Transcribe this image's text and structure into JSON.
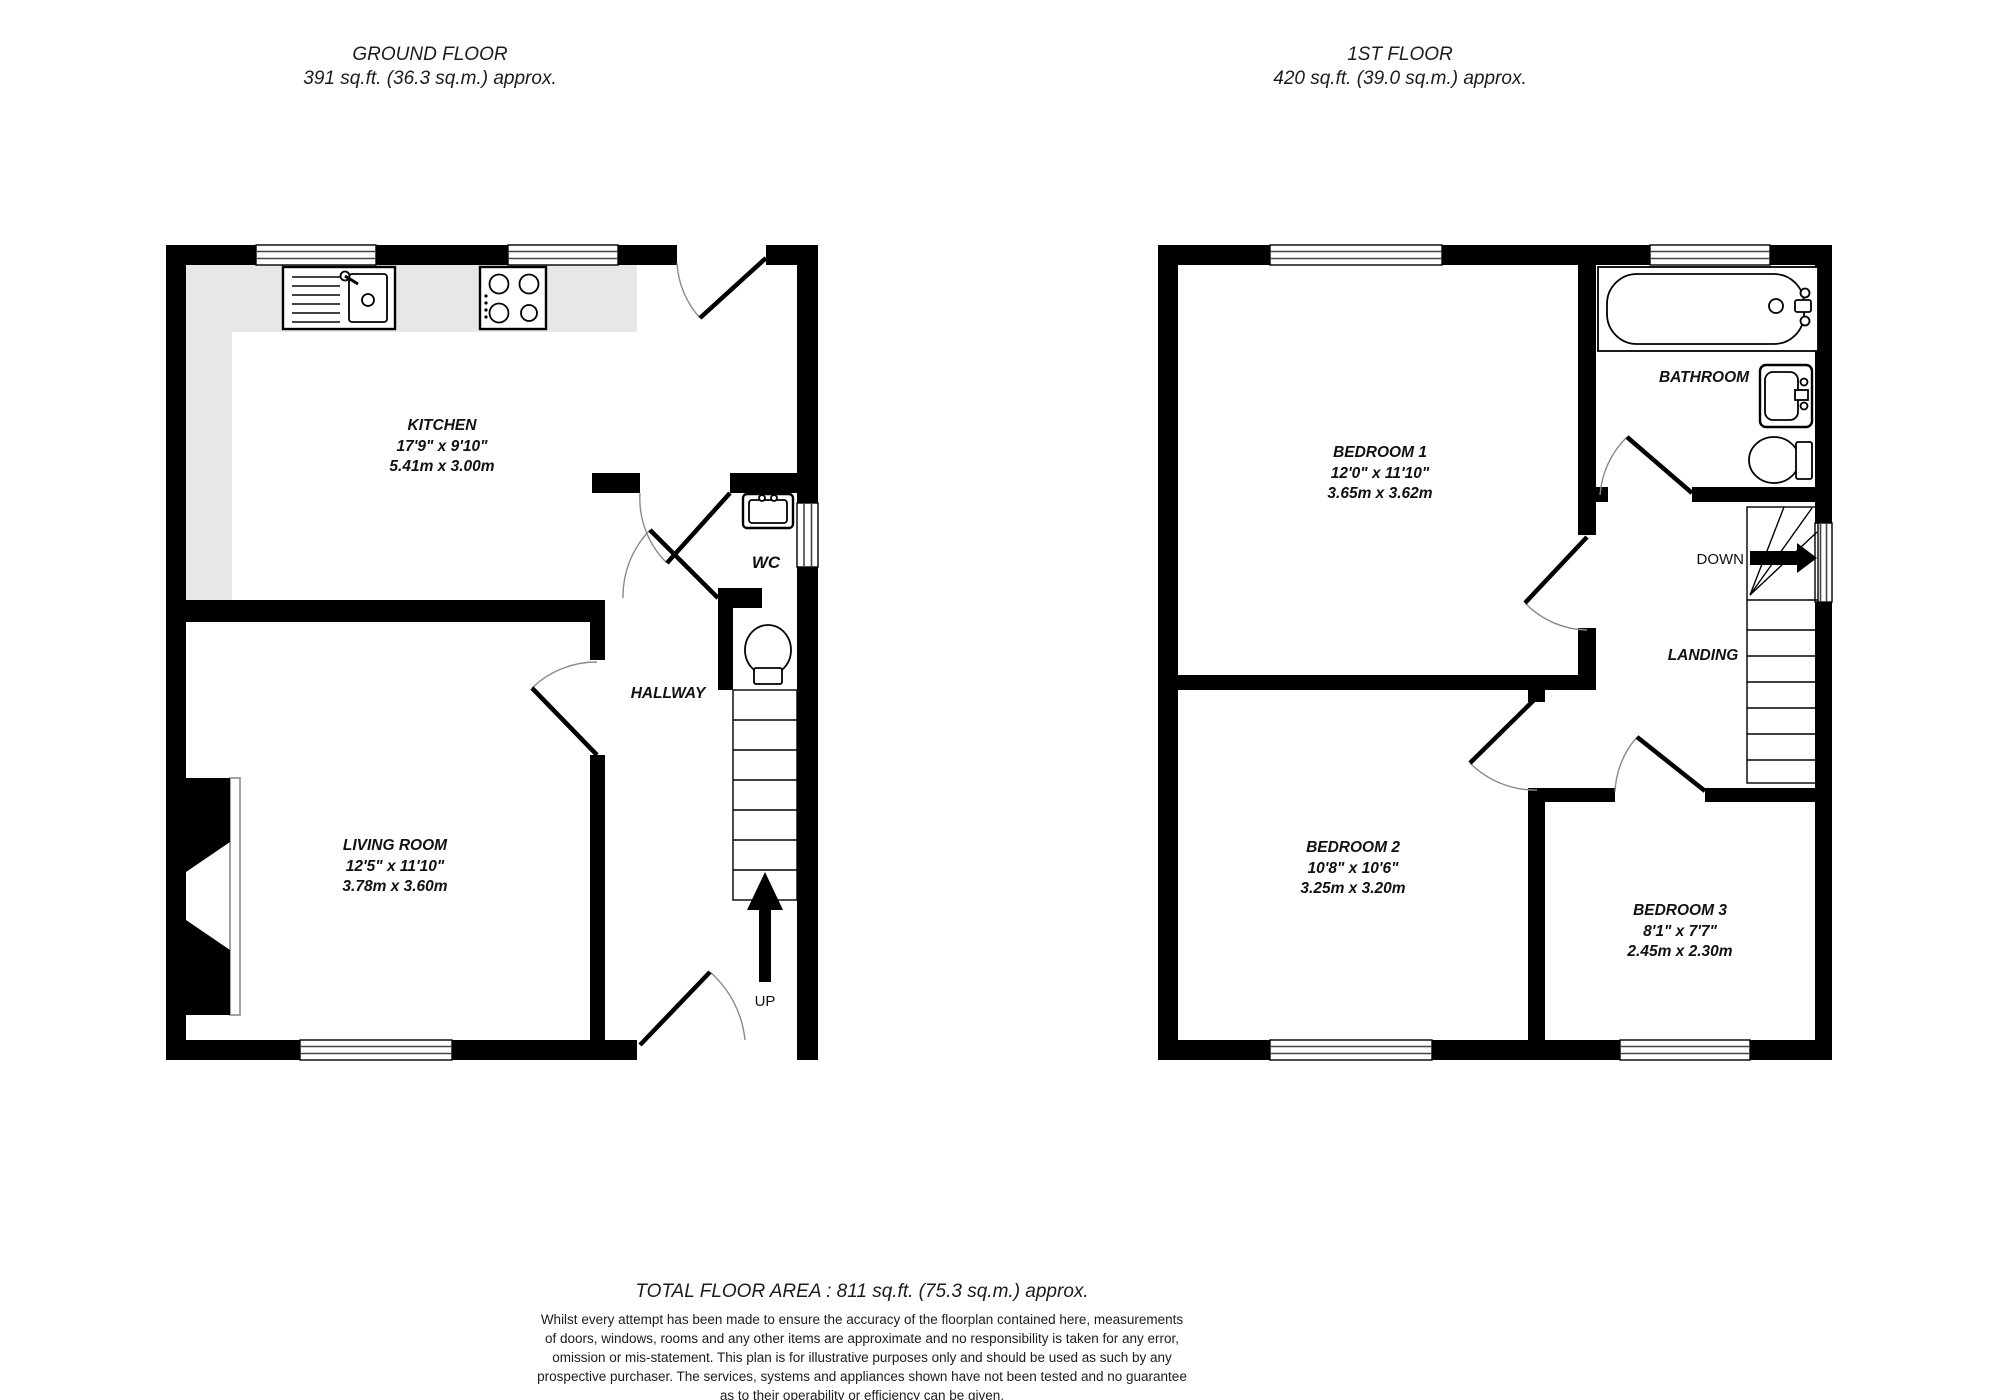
{
  "floors": [
    {
      "title": "GROUND FLOOR",
      "area": "391 sq.ft. (36.3 sq.m.) approx.",
      "stair_label": "UP",
      "rooms": [
        {
          "name": "KITCHEN",
          "imperial": "17'9\"  x 9'10\"",
          "metric": "5.41m  x 3.00m"
        },
        {
          "name": "WC",
          "imperial": "",
          "metric": ""
        },
        {
          "name": "HALLWAY",
          "imperial": "",
          "metric": ""
        },
        {
          "name": "LIVING ROOM",
          "imperial": "12'5\"  x 11'10\"",
          "metric": "3.78m  x 3.60m"
        }
      ],
      "icons": [
        "kitchen-sink-icon",
        "hob-icon",
        "wc-sink-icon",
        "toilet-icon",
        "stairs-up-icon",
        "fireplace-icon"
      ]
    },
    {
      "title": "1ST FLOOR",
      "area": "420 sq.ft. (39.0 sq.m.) approx.",
      "stair_label": "DOWN",
      "rooms": [
        {
          "name": "BEDROOM 1",
          "imperial": "12'0\"  x 11'10\"",
          "metric": "3.65m  x 3.62m"
        },
        {
          "name": "BATHROOM",
          "imperial": "",
          "metric": ""
        },
        {
          "name": "LANDING",
          "imperial": "",
          "metric": ""
        },
        {
          "name": "BEDROOM 2",
          "imperial": "10'8\"  x 10'6\"",
          "metric": "3.25m  x 3.20m"
        },
        {
          "name": "BEDROOM 3",
          "imperial": "8'1\"  x 7'7\"",
          "metric": "2.45m  x 2.30m"
        }
      ],
      "icons": [
        "bath-icon",
        "bathroom-sink-icon",
        "toilet-icon",
        "stairs-down-icon"
      ]
    }
  ],
  "footer": {
    "total": "TOTAL FLOOR AREA : 811 sq.ft. (75.3 sq.m.) approx.",
    "disclaimer_lines": [
      "Whilst every attempt has been made to ensure the accuracy of the floorplan contained here, measurements",
      "of doors, windows, rooms and any other items are approximate and no responsibility is taken for any error,",
      "omission or mis-statement. This plan is for illustrative purposes only and should be used as such by any",
      "prospective purchaser. The services, systems and appliances shown have not been tested and no guarantee",
      "as to their operability or efficiency can be given."
    ],
    "credit": "Made with Metropix ©2026"
  },
  "colors": {
    "wall": "#000000",
    "counter": "#e7e7e7",
    "door_arc": "#8a8a8a",
    "background": "#ffffff",
    "text": "#111111"
  }
}
